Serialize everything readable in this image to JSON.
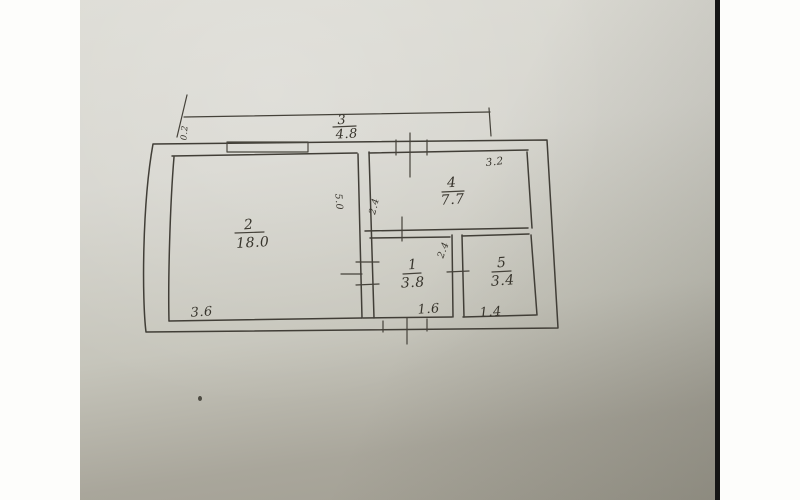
{
  "meta": {
    "kind": "photo of hand-drawn apartment floor plan sketch"
  },
  "colors": {
    "margin": "#fdfdfb",
    "paper_light": "#dcdbd4",
    "paper_dark": "#a19e92",
    "ink": "#3a372f",
    "photo_edge": "#151515"
  },
  "plan": {
    "top_dim": {
      "num": "3",
      "value": "4.8"
    },
    "offset_dim": "0.2",
    "rooms": {
      "room2": {
        "number": "2",
        "area": "18.0",
        "width": "3.6",
        "height": "5.0"
      },
      "room4": {
        "number": "4",
        "area": "7.7",
        "width": "3.2",
        "height": "2.4"
      },
      "room1": {
        "number": "1",
        "area": "3.8",
        "width": "1.6",
        "height": "2.4"
      },
      "room5": {
        "number": "5",
        "area": "3.4",
        "width": "1.4"
      }
    }
  }
}
